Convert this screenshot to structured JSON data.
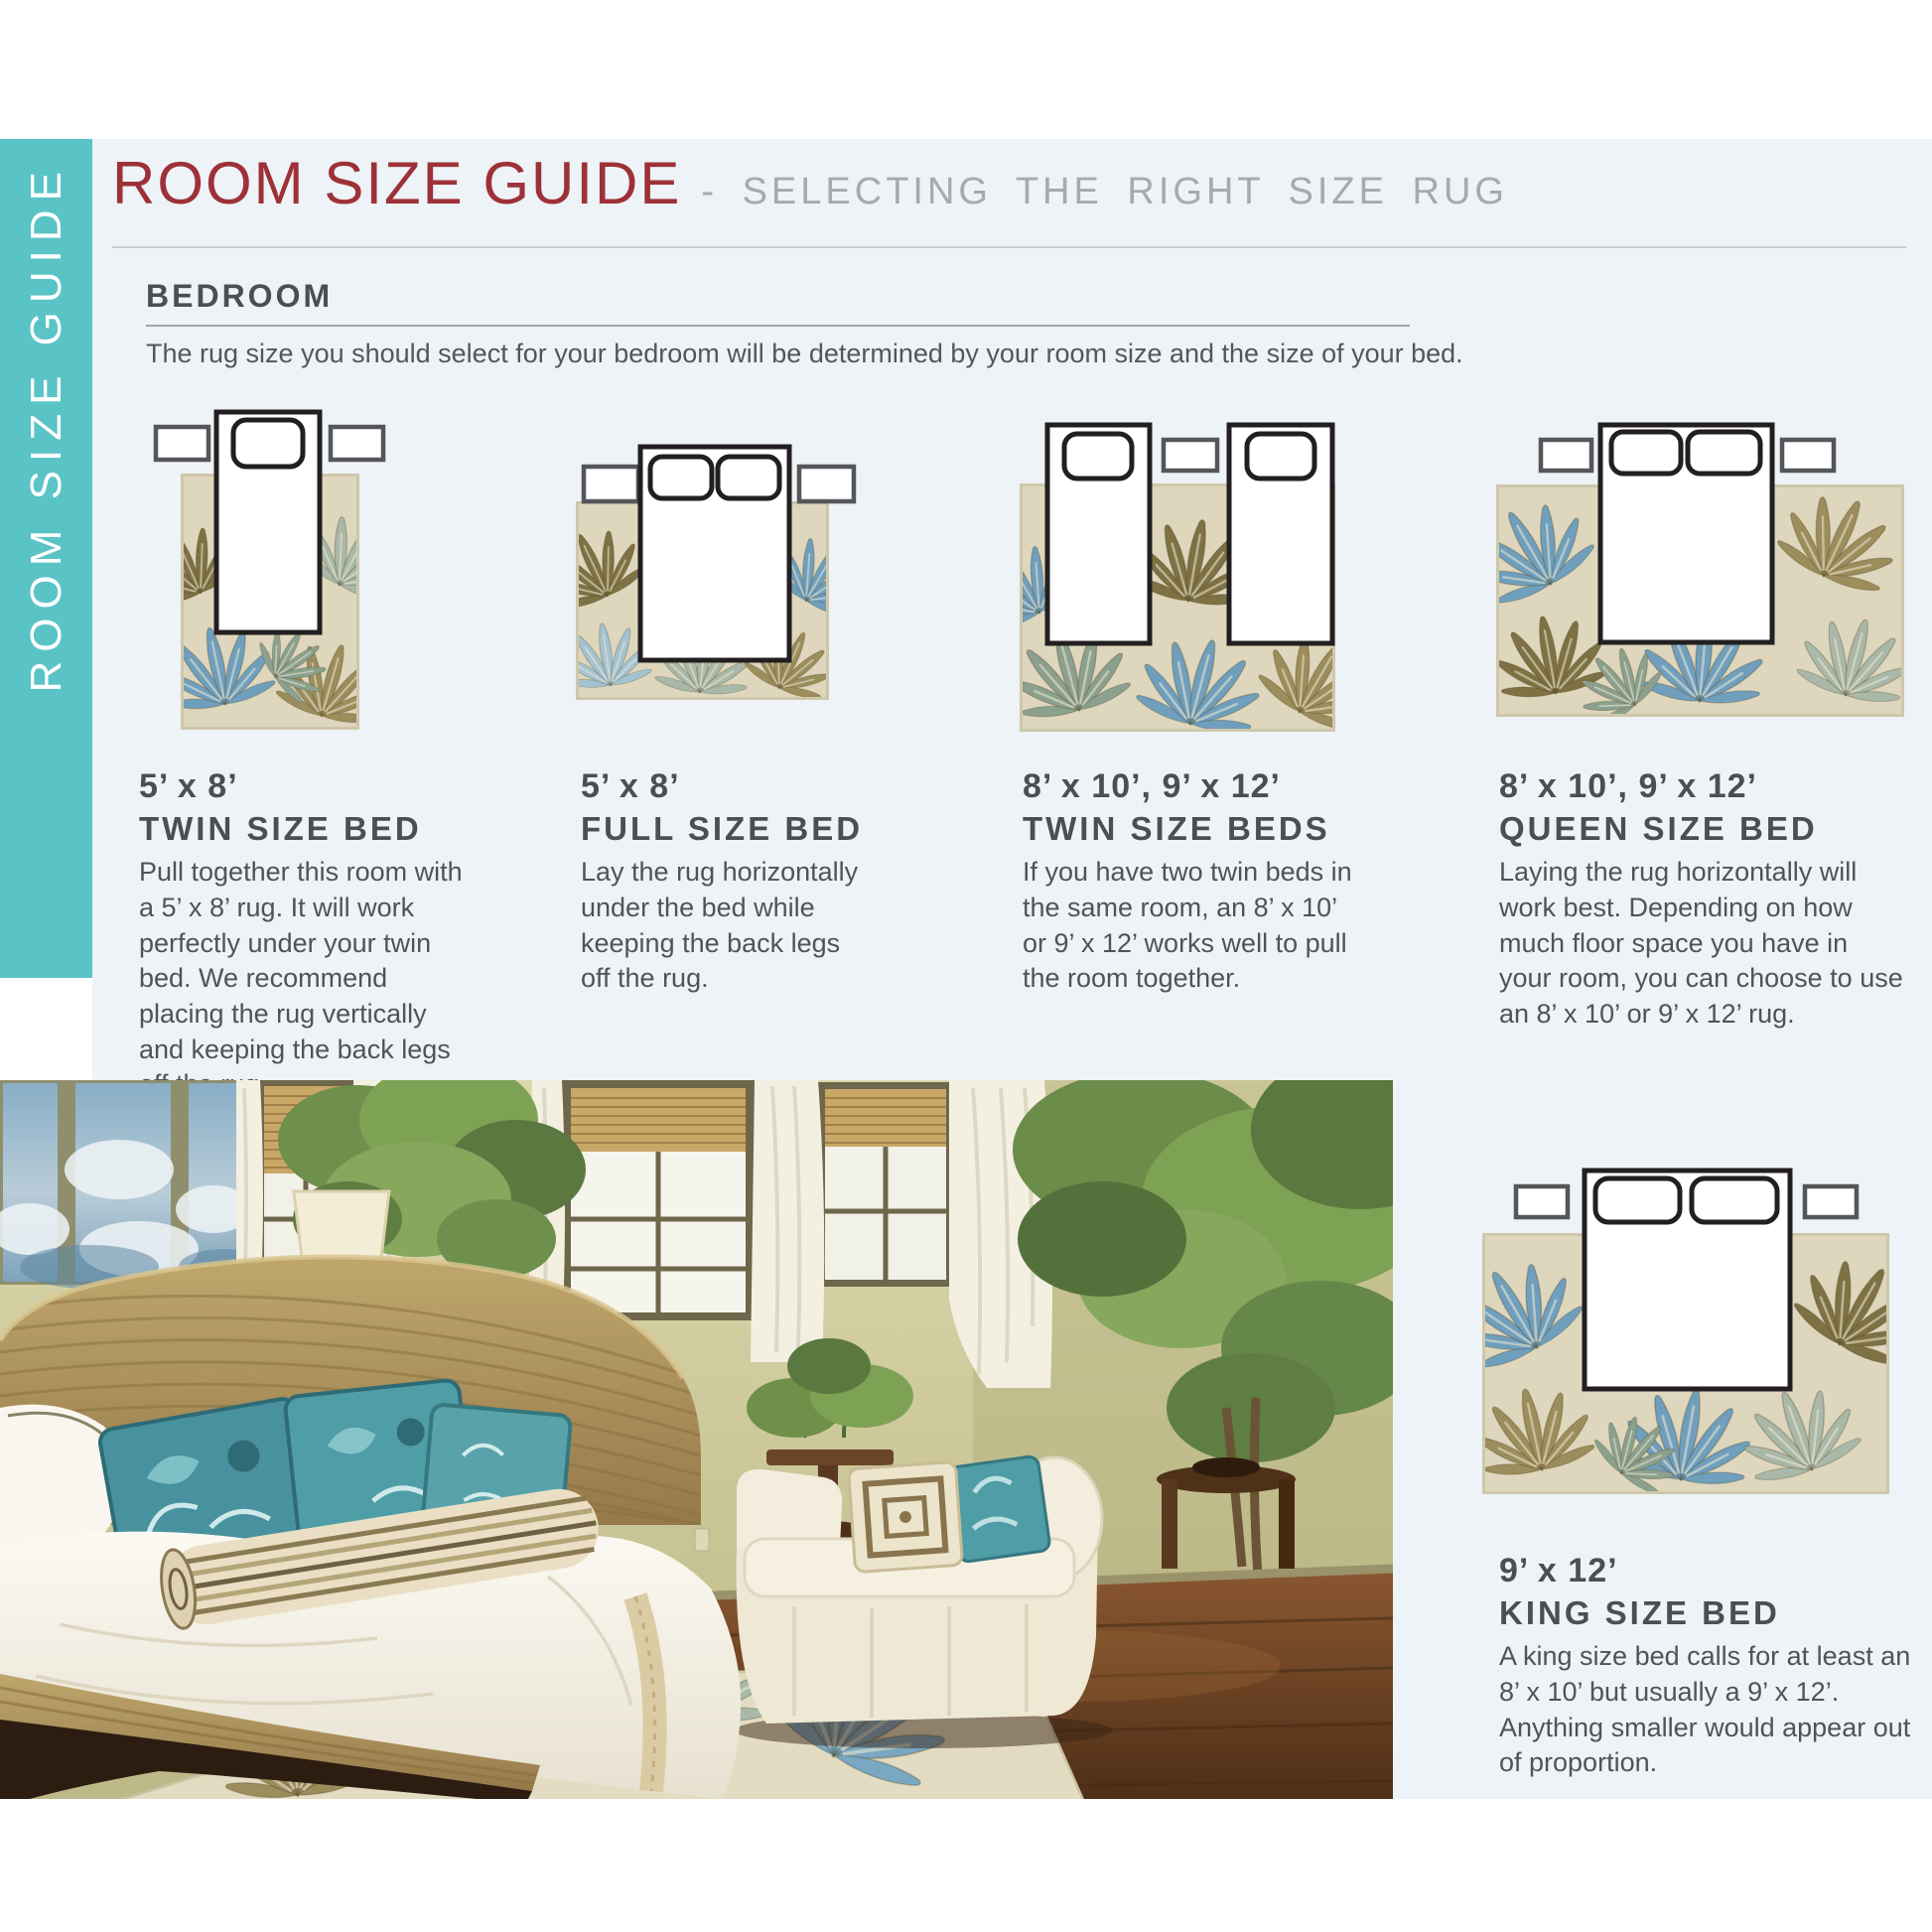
{
  "colors": {
    "accent_teal": "#5ac3c6",
    "content_background": "#edf3f6",
    "title_red": "#9e3138",
    "subtitle_gray": "#a7a9ac",
    "heading_gray": "#4d4e50",
    "body_gray": "#515357",
    "rug_cream": "#ded7bd",
    "leaf_olive": "#7e7144",
    "leaf_sage": "#a9b8a8",
    "leaf_blue": "#6f9fbd",
    "bed_outline": "#231f20",
    "nightstand_outline": "#55565a"
  },
  "sidebar": {
    "label": "ROOM SIZE GUIDE"
  },
  "header": {
    "title": "ROOM SIZE GUIDE",
    "subtitle": "- SELECTING THE RIGHT SIZE RUG"
  },
  "section": {
    "heading": "BEDROOM",
    "intro": "The rug size you should select for your bedroom will be determined by your room size and the size of your bed."
  },
  "guides": [
    {
      "size": "5’ x 8’",
      "bed_type": "TWIN SIZE BED",
      "description": "Pull together this room with a 5’ x 8’ rug. It will work perfectly under your twin bed. We recommend placing the rug vertically and keeping the back legs off the rug.",
      "diagram": {
        "rug_orientation": "vertical",
        "beds": 1,
        "pillows": 1,
        "nightstands": 2
      }
    },
    {
      "size": "5’ x 8’",
      "bed_type": "FULL SIZE BED",
      "description": "Lay the rug horizontally under the bed while keeping the back legs off the rug.",
      "diagram": {
        "rug_orientation": "horizontal",
        "beds": 1,
        "pillows": 2,
        "nightstands": 2
      }
    },
    {
      "size": "8’ x 10’, 9’ x 12’",
      "bed_type": "TWIN SIZE BEDS",
      "description": "If you have two twin beds in the same room, an 8’ x 10’ or 9’ x 12’ works well to pull the room together.",
      "diagram": {
        "rug_orientation": "horizontal",
        "beds": 2,
        "pillows": 2,
        "nightstands": 1
      }
    },
    {
      "size": "8’ x 10’, 9’ x 12’",
      "bed_type": "QUEEN SIZE BED",
      "description": "Laying the rug horizontally will work best. Depending on how much floor space you have in your room, you can choose to use an 8’ x 10’ or 9’ x 12’ rug.",
      "diagram": {
        "rug_orientation": "horizontal",
        "beds": 1,
        "pillows": 2,
        "nightstands": 2
      }
    },
    {
      "size": "9’ x 12’",
      "bed_type": "KING SIZE BED",
      "description": "A king size bed calls for at least an 8’ x 10’ but usually a 9’ x 12’. Anything smaller would appear out of proportion.",
      "diagram": {
        "rug_orientation": "horizontal",
        "beds": 1,
        "pillows": 2,
        "nightstands": 2
      }
    }
  ]
}
